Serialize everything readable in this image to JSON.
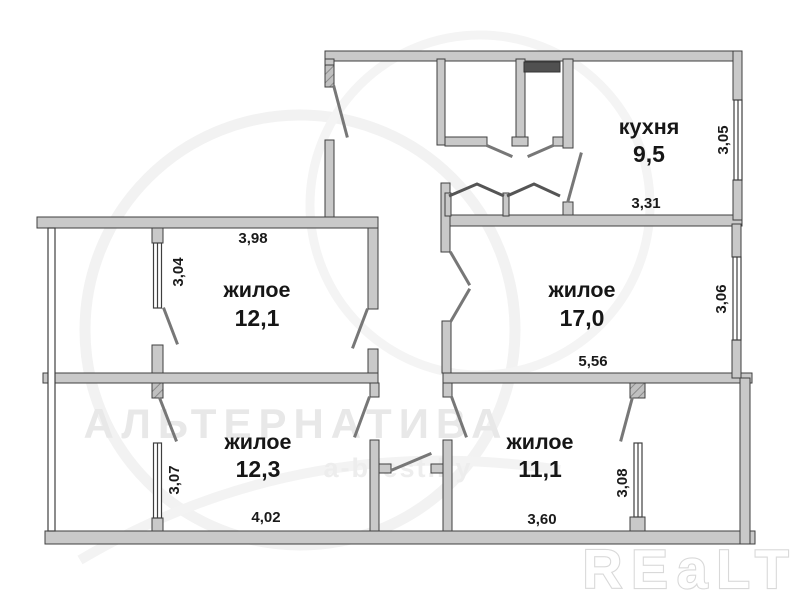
{
  "plan": {
    "type": "apartment-floor-plan",
    "rooms": [
      {
        "id": "kitchen",
        "label": "кухня",
        "area": "9,5",
        "dim_horizontal": "3,31",
        "dim_vertical": "3,05"
      },
      {
        "id": "living-12-1",
        "label": "жилое",
        "area": "12,1",
        "dim_horizontal": "3,98",
        "dim_vertical": "3,04"
      },
      {
        "id": "living-17-0",
        "label": "жилое",
        "area": "17,0",
        "dim_horizontal": "5,56",
        "dim_vertical": "3,06"
      },
      {
        "id": "living-12-3",
        "label": "жилое",
        "area": "12,3",
        "dim_horizontal": "4,02",
        "dim_vertical": "3,07"
      },
      {
        "id": "living-11-1",
        "label": "жилое",
        "area": "11,1",
        "dim_horizontal": "3,60",
        "dim_vertical": "3,08"
      }
    ],
    "watermark": {
      "brand": "АЛЬТЕРНАТИВА",
      "site": "a-brest.by",
      "logo": "REaLT"
    },
    "colors": {
      "wall_fill": "#c9c9c9",
      "wall_edge": "#3f3f3f",
      "door_leaf": "#777777",
      "vent_shaft": "#505050",
      "label_text": "#161616",
      "watermark_gray": "#e8e8e8",
      "background": "#ffffff"
    }
  }
}
